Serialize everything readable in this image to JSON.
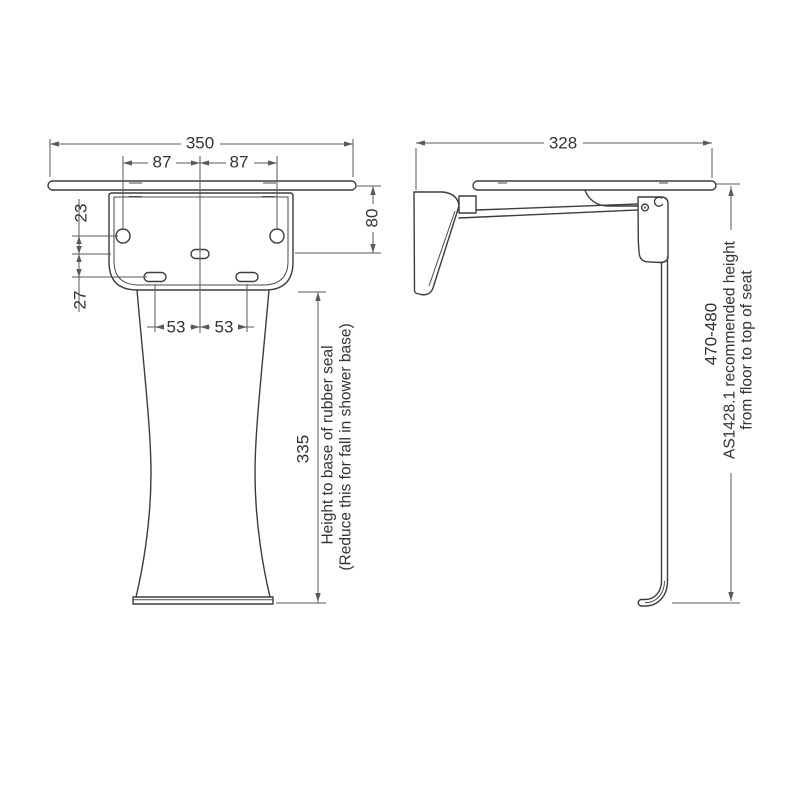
{
  "front_view": {
    "dim_overall_width": "350",
    "dim_fixing_left": "87",
    "dim_fixing_right": "87",
    "dim_plate_to_holes": "23",
    "dim_holes_to_slots": "27",
    "dim_slot_left": "53",
    "dim_slot_right": "53",
    "dim_bracket_height": "80",
    "dim_height_to_seal": "335",
    "note_line1": "Height to base of rubber seal",
    "note_line2": "(Reduce this for fall in shower base)"
  },
  "side_view": {
    "dim_overall_depth": "328",
    "dim_recommended_height": "470-480",
    "note_line1": "AS1428.1 recommended height",
    "note_line2": "from floor to top of seat"
  },
  "colors": {
    "background": "#ffffff",
    "part_outline": "#3d3d3d",
    "dimension_line": "#5a5a5a",
    "text": "#333333"
  }
}
